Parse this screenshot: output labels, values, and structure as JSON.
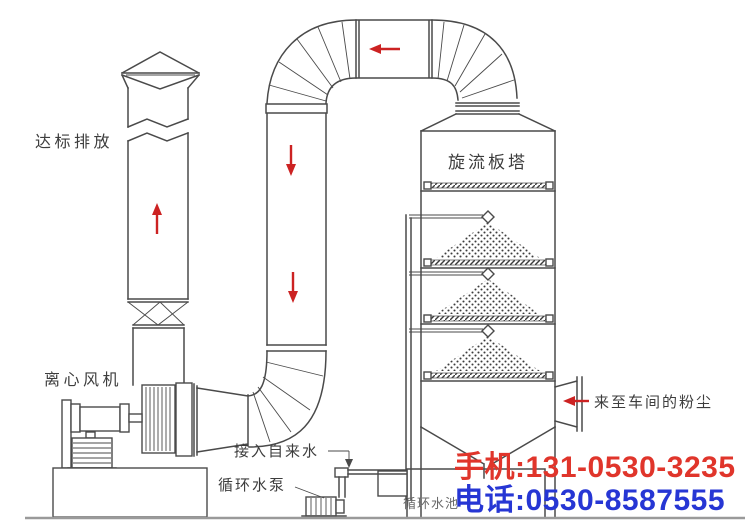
{
  "labels": {
    "emission": "达标排放",
    "fan": "离心风机",
    "tower": "旋流板塔",
    "dust_inlet": "来至车间的粉尘",
    "tap_water": "接入自来水",
    "pump": "循环水泵",
    "pool": "循环水池"
  },
  "contact": {
    "mobile": "手机:131-0530-3235",
    "phone": "电话:0530-8587555"
  },
  "colors": {
    "background": "#ffffff",
    "line": "#4a4a4a",
    "label": "#3d3d3d",
    "arrow": "#cc2222",
    "mobile": "#e0352b",
    "phone": "#2636d4"
  }
}
